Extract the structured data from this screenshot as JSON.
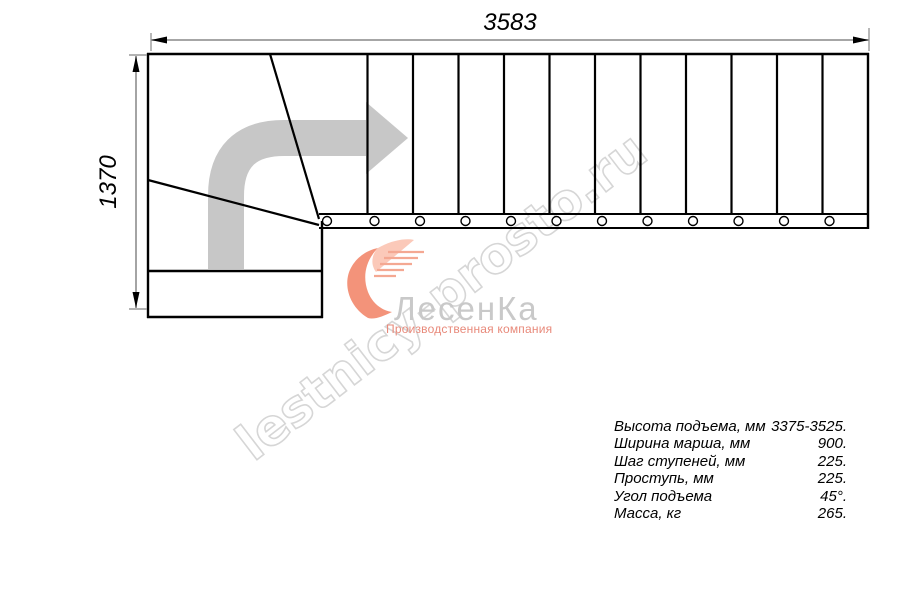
{
  "drawing": {
    "dimension_top": "3583",
    "dimension_left": "1370",
    "description": "staircase plan view, L-shaped with winder turn and straight flight"
  },
  "watermark": {
    "text": "lestnicy-prosto.ru"
  },
  "logo": {
    "title": "ЛесенКа",
    "subtitle": "Производственная компания"
  },
  "specs": {
    "rows": [
      {
        "label": "Высота подъема, мм",
        "value": "3375-3525."
      },
      {
        "label": "Ширина марша, мм",
        "value": "900."
      },
      {
        "label": "Шаг ступеней, мм",
        "value": "225."
      },
      {
        "label": "Проступь, мм",
        "value": "225."
      },
      {
        "label": "Угол подъема",
        "value": "45°."
      },
      {
        "label": "Масса, кг",
        "value": "265."
      }
    ]
  },
  "colors": {
    "line": "#000000",
    "dimension_line": "#9a9a9a",
    "direction_arrow": "#c7c7c7",
    "watermark": "#d6d6d6",
    "logo_accent": "#ee7a58",
    "logo_accent_light": "#f6b0a0",
    "logo_text": "#c9c9c9",
    "logo_subtitle": "#e8897a"
  }
}
